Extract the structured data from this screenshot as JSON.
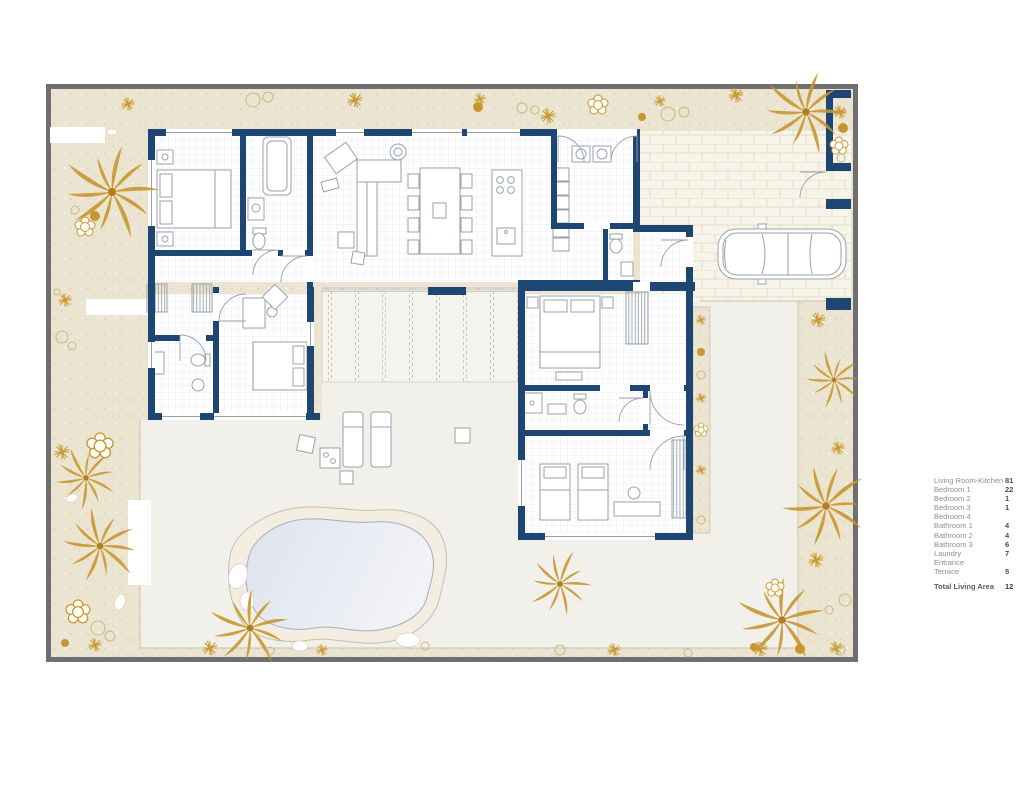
{
  "figure_type": "villa-floor-plan",
  "legend": {
    "rows": [
      {
        "label": "Living Room-Kitchen",
        "value": "81"
      },
      {
        "label": "Bedroom 1",
        "value": "22"
      },
      {
        "label": "Bedroom 2",
        "value": "1"
      },
      {
        "label": "Bedroom 3",
        "value": "1"
      },
      {
        "label": "Bedroom 4",
        "value": ""
      },
      {
        "label": "Bathroom 1",
        "value": "4"
      },
      {
        "label": "Bathroom 2",
        "value": "4"
      },
      {
        "label": "Bathroom 3",
        "value": "6"
      },
      {
        "label": "Laundry",
        "value": "7"
      },
      {
        "label": "Entrance",
        "value": ""
      },
      {
        "label": "Terrace",
        "value": "5"
      }
    ],
    "total": {
      "label": "Total Living Area",
      "value": "12"
    }
  },
  "plan": {
    "colors": {
      "wall_navy": "#1d4673",
      "sand": "#ebe4d0",
      "gold_plants": "#c8962e",
      "terrace": "#f1f0ea",
      "boundary_gray": "#6f6f6f",
      "furniture_gray": "#9aa2ab",
      "pool_water": "#e2e7ef",
      "brick_joint": "#e4dcc5"
    },
    "icons": [
      "palm-icon",
      "shrub-icon",
      "plant-burst-icon",
      "pool",
      "car",
      "sun-lounger"
    ]
  }
}
